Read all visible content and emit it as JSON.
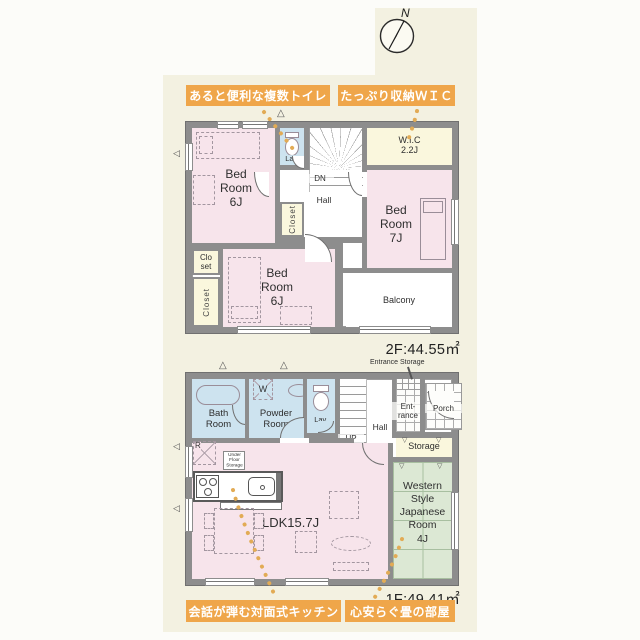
{
  "colors": {
    "accent_orange": "#efa64a",
    "leader_dots": "#e2ab55",
    "wall_gray": "#8d8d8d",
    "bedroom_pink": "#f7e4eb",
    "wet_area_blue": "#cde3ef",
    "closet_cream": "#faf7dd",
    "tatami_green": "#dce8d4",
    "background_cream": "#f3f1e1"
  },
  "compass": {
    "north_label": "N"
  },
  "icons": {
    "triangle_up": "△",
    "triangle_left": "◁",
    "triangle_down": "▽"
  },
  "callouts": {
    "top_left": "あると便利な複数トイレ",
    "top_right": "たっぷり収納ＷＩＣ",
    "bottom_left": "会話が弾む対面式キッチン",
    "bottom_right": "心安らぐ畳の部屋"
  },
  "floor2": {
    "area_label": "2F:44.55㎡",
    "rooms": {
      "bedroom_upper": "Bed\nRoom\n6J",
      "lavatory": "Lav.",
      "stairs_down": "DN",
      "hall": "Hall",
      "wic": "W.I.C\n2.2J",
      "bedroom_right": "Bed\nRoom\n7J",
      "closet_mid": "Closet",
      "closet_small": "Clo\nset",
      "closet_left": "Closet",
      "bedroom_lower": "Bed\nRoom\n6J",
      "balcony": "Balcony"
    }
  },
  "floor1": {
    "area_label": "1F:49.41㎡",
    "entrance_storage_label": "Entrance Storage",
    "rooms": {
      "bath": "Bath\nRoom",
      "washer": "W",
      "powder": "Powder\nRoom",
      "lavatory": "Lav.",
      "stairs_up": "UP",
      "hall": "Hall",
      "entrance": "Ent-\nrance",
      "porch": "Porch",
      "storage": "Storage",
      "refrigerator": "R",
      "under_floor_storage": "Under\nFloor\nStorage",
      "ldk": "LDK15.7J",
      "japanese_room": "Western\nStyle\nJapanese\nRoom\n4J"
    }
  }
}
